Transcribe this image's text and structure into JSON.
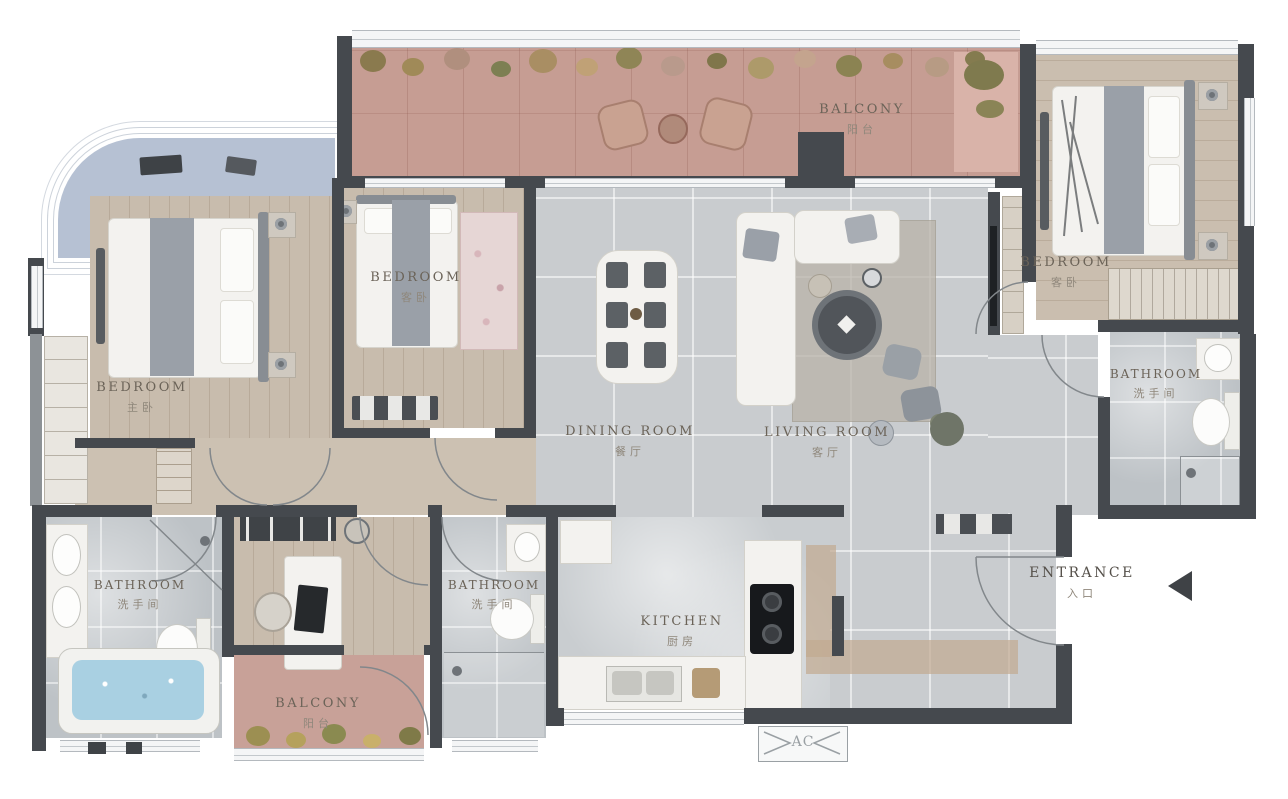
{
  "rooms": [
    {
      "id": "balcony-top",
      "label": "BALCONY",
      "label_cn": "阳台"
    },
    {
      "id": "bedroom-master",
      "label": "BEDROOM",
      "label_cn": "主卧"
    },
    {
      "id": "bedroom-middle",
      "label": "BEDROOM",
      "label_cn": "客卧"
    },
    {
      "id": "dining-room",
      "label": "DINING ROOM",
      "label_cn": "餐厅"
    },
    {
      "id": "living-room",
      "label": "LIVING ROOM",
      "label_cn": "客厅"
    },
    {
      "id": "bedroom-right",
      "label": "BEDROOM",
      "label_cn": "客卧"
    },
    {
      "id": "bathroom-right",
      "label": "BATHROOM",
      "label_cn": "洗手间"
    },
    {
      "id": "bathroom-left",
      "label": "BATHROOM",
      "label_cn": "洗手间"
    },
    {
      "id": "bathroom-middle",
      "label": "BATHROOM",
      "label_cn": "洗手间"
    },
    {
      "id": "kitchen",
      "label": "KITCHEN",
      "label_cn": "厨房"
    },
    {
      "id": "balcony-bottom",
      "label": "BALCONY",
      "label_cn": "阳台"
    }
  ],
  "annotations": {
    "entrance": {
      "label": "ENTRANCE",
      "label_cn": "入口"
    },
    "ac": {
      "label": "AC"
    }
  },
  "colors": {
    "wall": "#45494e",
    "wood_floor": "#c8bcad",
    "tile_floor": "#c9cccf",
    "balcony_floor": "#c69d93",
    "bath_floor": "#bdc2c6",
    "bay_window": "#b6c1d3",
    "bathtub_water": "#a9d0e2",
    "label_text": "#6b6358"
  }
}
